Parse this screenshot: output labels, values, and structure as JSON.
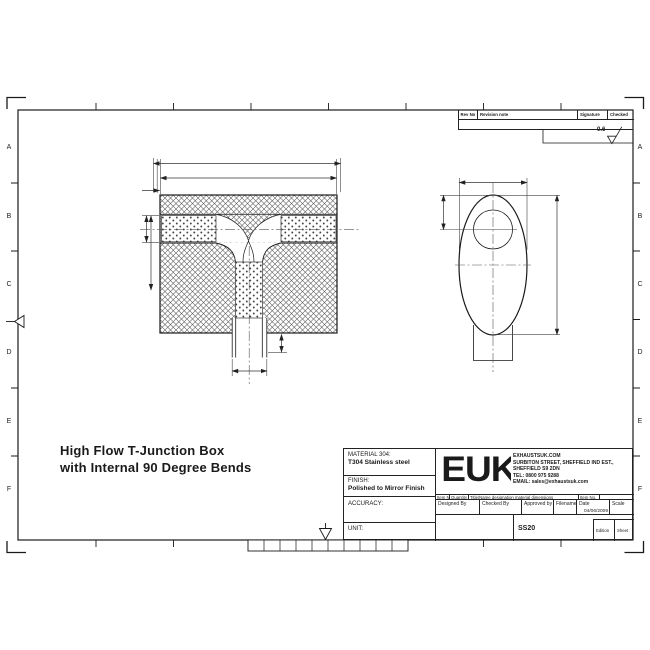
{
  "sheet": {
    "title_line1": "High Flow T-Junction Box",
    "title_line2": "with Internal 90 Degree Bends",
    "zone_labels": [
      "A",
      "B",
      "C",
      "D",
      "E",
      "F"
    ],
    "surface_finish_value": "0.6"
  },
  "revision_table": {
    "rev_no": "Rev No",
    "revision_note": "Revision note",
    "signature": "Signature",
    "checked": "Checked"
  },
  "title_block": {
    "material_label": "MATERIAL 304:",
    "material_value": "T304 Stainless steel",
    "finish_label": "FINISH:",
    "finish_value": "Polished to Mirror Finish",
    "accuracy_label": "ACCURACY:",
    "unit_label": "UNIT:",
    "logo_text": "EUK",
    "company_lines": [
      "EXHAUSTSUK.COM",
      "SURBITON STREET, SHEFFIELD IND EST.,",
      "SHEFFIELD S9 2DN",
      "TEL: 0800 975 9288",
      "EMAIL: sales@exhaustsuk.com"
    ],
    "item_headers": [
      "Item No",
      "Quantity",
      "Title/Name designation material dimensions",
      "Item No."
    ],
    "approval_headers": [
      "Designed By",
      "Checked By",
      "Approved by date",
      "Filename",
      "Date",
      "Scale"
    ],
    "date_value": "04/06/2009",
    "filename_value": "SS20",
    "edition_label": "Edition",
    "sheet_label": "Sheet"
  },
  "colors": {
    "background": "#ffffff",
    "line": "#1a1a1a",
    "hatch": "#555555"
  }
}
